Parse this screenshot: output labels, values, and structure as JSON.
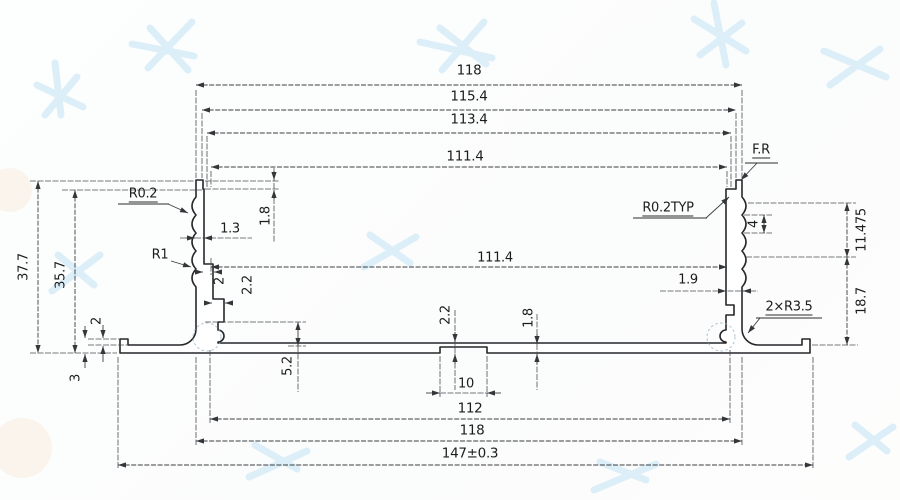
{
  "colors": {
    "profile_line": "#25272a",
    "dim_line": "#3a3d40",
    "label_text": "#1c1c1c",
    "watermark_blue": "#d6ecf7",
    "paper": "#fdfefe"
  },
  "dimensions": {
    "top_widths": {
      "overall": "118",
      "second": "115.4",
      "third": "113.4",
      "inner": "111.4"
    },
    "left_side": {
      "height_overall": "37.7",
      "height_inner": "35.7",
      "lip_width": "1.3",
      "lip_height": "1.8",
      "serration_radius": "R0.2",
      "groove_radius": "R1",
      "rib_step_1": "2",
      "rib_step_2": "2.2",
      "step_height": "5.2",
      "flange_thickness": "2",
      "flange_end_height": "3"
    },
    "right_side": {
      "corner_finish": "F.R",
      "serration_radius_typ": "R0.2TYP",
      "serration_pitch": "4",
      "serration_zone_height": "11.475",
      "lower_wall_height": "18.7",
      "wall_thickness": "1.9",
      "corner_radius": "2×R3.5"
    },
    "middle": {
      "inner_width": "111.4",
      "base_thickness": "2.2",
      "groove_wall": "1.8"
    },
    "bottom_widths": {
      "slot": "10",
      "inner": "112",
      "outer": "118",
      "overall": "147±0.3"
    }
  }
}
